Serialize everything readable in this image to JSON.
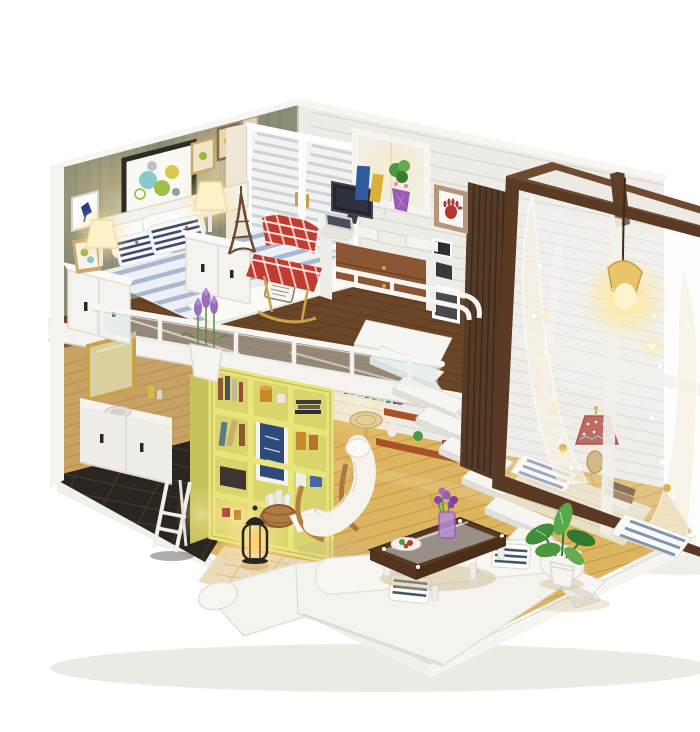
{
  "scene": {
    "subject": "DIY miniature dollhouse kit - two-story loft apartment diorama with lit lamps, photographed on a white studio background",
    "style": "product photo",
    "visible_text": "none legible (tiny decorative stamp print on bed blanket, illegible)"
  },
  "colors": {
    "background": "#ffffff",
    "left_wall": "#8b8c76",
    "back_wall": "#edece7",
    "trim": "#f6f6f2",
    "kitchen_wall": "#c8a265",
    "kitchen_tile": "#2a2520",
    "loft_wood": "#6a4527",
    "floor_wood": "#ddb45f",
    "floor_seam": "#bc923f",
    "bookshelf": "#e9e47c",
    "bookshelf_side": "#c6c35e",
    "shelf_orange": "#a85327",
    "frame_brown": "#5a3a24",
    "slat_brown": "#553a26",
    "stairs_white": "#f6f5f1",
    "sofa_white": "#f5f3ee",
    "table_walnut": "#5b3a22",
    "wardrobe_white": "#f4f3ef",
    "plaid_red": "#c13b2e",
    "duvet_stripe": "#a2b2cb",
    "pillow_navy": "#3e4c68",
    "lavender": "#9a6cc0",
    "plant_green": "#4c9840",
    "lamp_shade_red": "#b5403a",
    "cushion_stripe": "#8095b2",
    "glow_warm": "#ffd98a"
  },
  "inventory": {
    "loft_bedroom": [
      "double bed with blue-white striped duvet",
      "navy striped pillows",
      "white headboard",
      "two white nightstands",
      "two lit white table lamps",
      "Eiffel tower figurine",
      "leaning gold picture frame",
      "gallery frames with circle art and dancer print",
      "white louvered double wardrobe",
      "desk with monitor, laptop and gadgets",
      "blue and yellow books",
      "plant in purple faceted vase",
      "red plaid armchair",
      "window opening",
      "handprint picture frame",
      "black-and-white photo frames",
      "white loft railing with acrylic panels",
      "lavender planter box"
    ],
    "ground_floor": [
      "yellow cube bookshelf with books, jars and basket",
      "navy framed print",
      "woven basket with rolled papers",
      "lit black lantern lamp",
      "white knitted lounge chair with wood frame",
      "open book",
      "beige woven rug",
      "white L-shaped sofa",
      "blue striped sofa pillows",
      "walnut coffee table with glass top",
      "purple tulips in vase",
      "plate of food",
      "white floating staircase",
      "orange wall shelves with potted flowers",
      "under-loft counter with mosaic tiles and stool",
      "green potted plant"
    ],
    "kitchen_nook": [
      "gold framed mirror",
      "white vanity with sink and gold faucet",
      "glass bottles",
      "white step ladder",
      "black tile floor"
    ],
    "window_bay": [
      "dark walnut glass frame wall",
      "white polka-dot lace curtains",
      "lit hanging pendant light",
      "fairy light dots",
      "mosaic red table lamp",
      "two striped floor cushions",
      "stack of books",
      "beige mat"
    ]
  }
}
